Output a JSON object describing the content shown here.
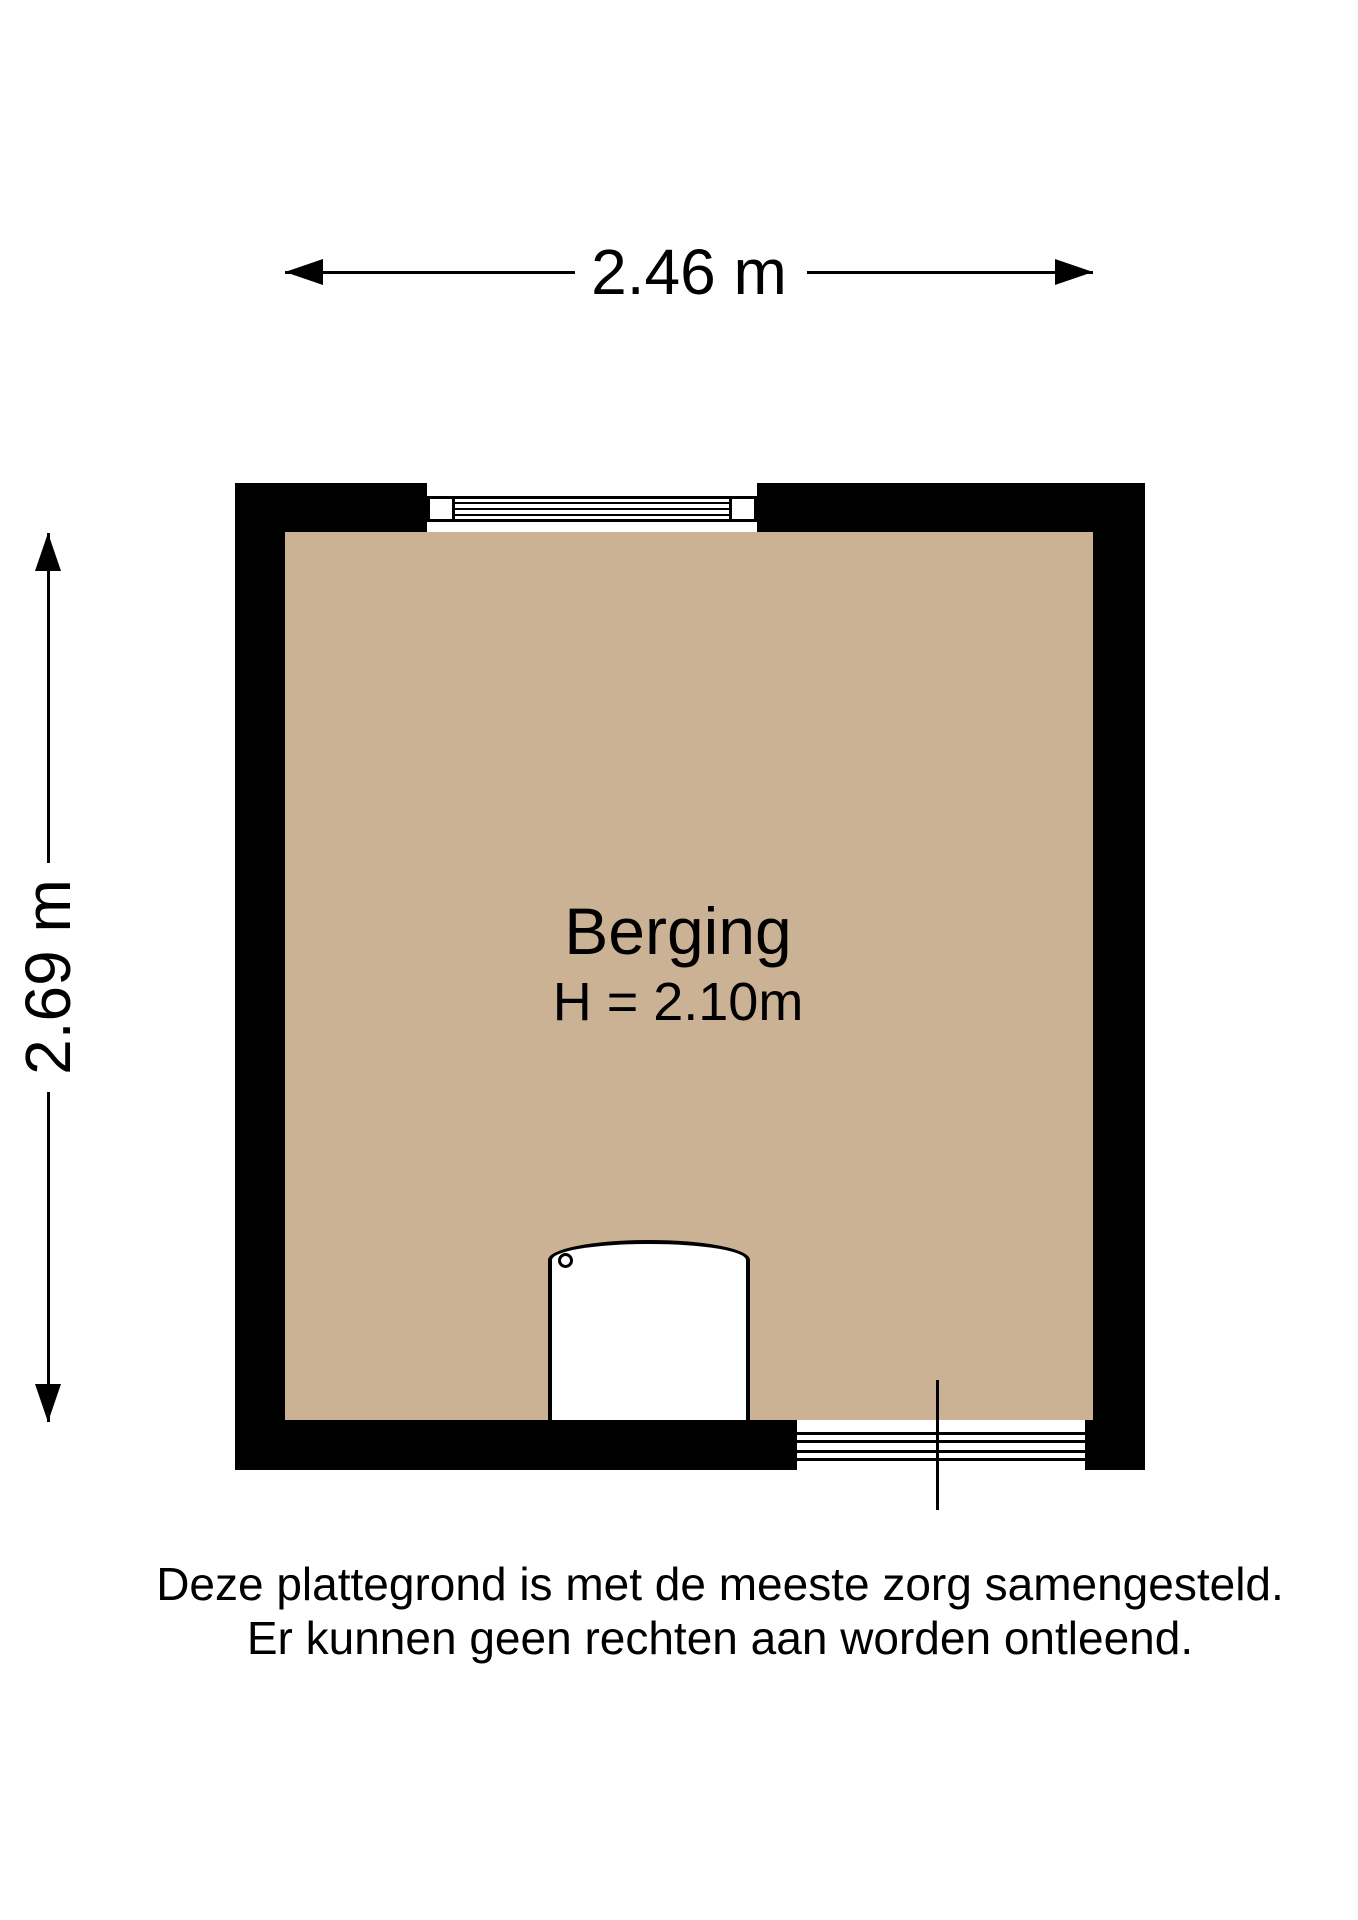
{
  "plan": {
    "room": {
      "name": "Berging",
      "height_label": "H = 2.10m"
    },
    "dimensions": {
      "width_label": "2.46 m",
      "height_label": "2.69 m"
    },
    "features": {
      "window": "window-top-wall",
      "door": "door-opening-bottom-right",
      "appliance": "boiler-unit"
    }
  },
  "disclaimer": {
    "line1": "Deze plattegrond is met de meeste zorg samengesteld.",
    "line2": "Er kunnen geen rechten aan worden ontleend."
  },
  "colors": {
    "floor": "#ccb294",
    "wall": "#000000"
  }
}
